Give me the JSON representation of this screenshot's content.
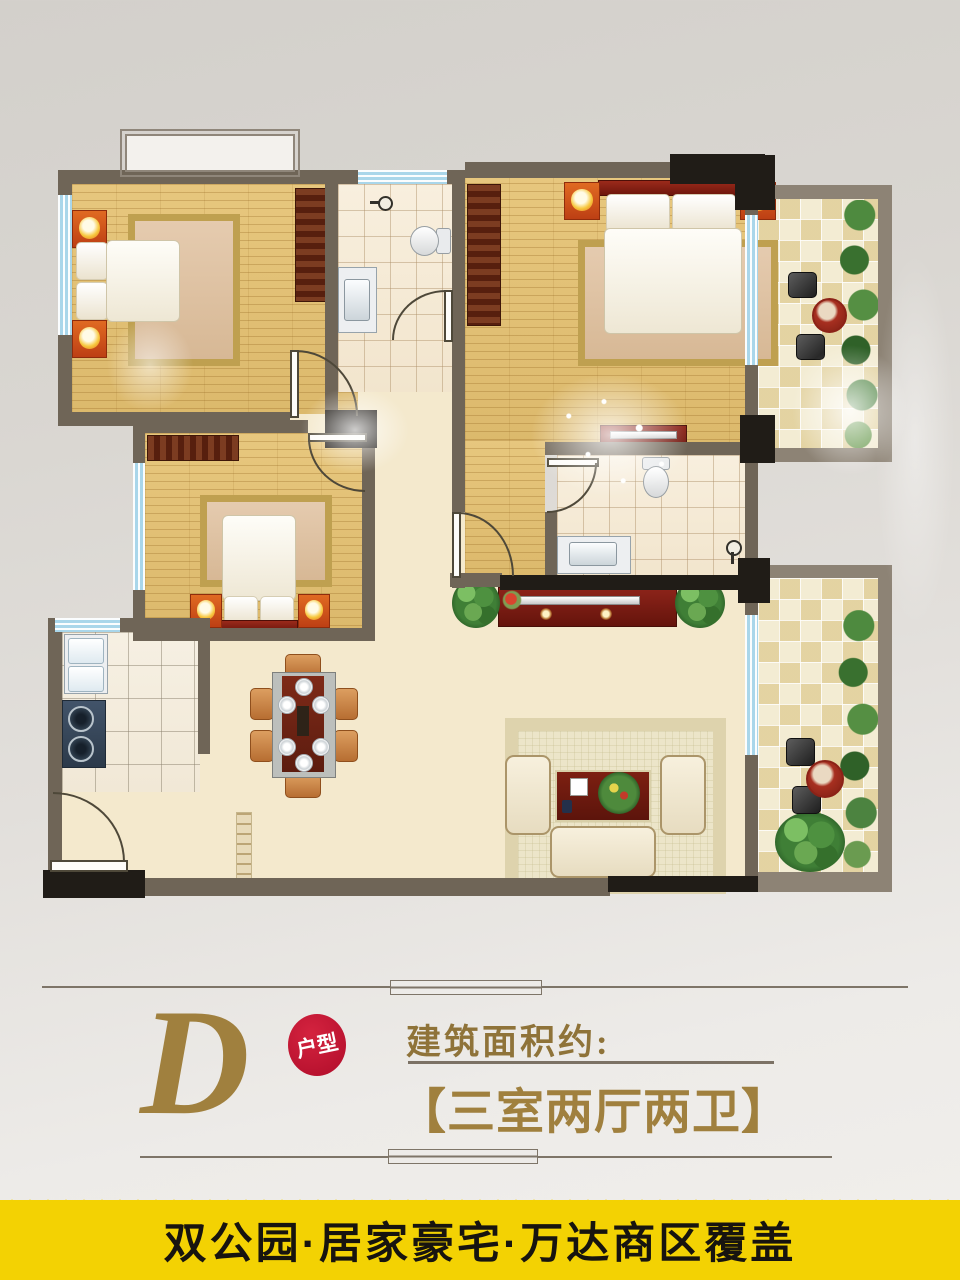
{
  "photo": {
    "background": "#dcd9d5"
  },
  "floor_plan": {
    "wall_color": "#6f6557",
    "balcony_wall_color": "#8d8375",
    "accent_black": "#201c17",
    "window_color": "#a9d6ea",
    "wood_floor_color": "#e2c176",
    "tile_floor_color": "#f6ecd9",
    "living_floor_color": "#f4e9cd",
    "rooms": [
      "bedroom-1",
      "bathroom-1",
      "master-bedroom",
      "north-balcony",
      "bedroom-2",
      "bathroom-2",
      "kitchen",
      "dining-area",
      "living-room",
      "south-balcony",
      "entry-hall"
    ],
    "furniture": [
      "double-bed",
      "nightstand-with-lamp",
      "wardrobe",
      "area-rug",
      "toilet",
      "vanity-sink",
      "shower-head",
      "kitchen-sink",
      "gas-stove",
      "dining-table-with-six-chairs",
      "runner-rug",
      "tv-stand",
      "sofa-set",
      "coffee-table-with-wreath",
      "potted-plant",
      "balcony-table-and-chairs",
      "bay-window"
    ]
  },
  "info": {
    "unit_letter": "D",
    "unit_badge": "户型",
    "area_label": "建筑面积约:",
    "layout_text": "【三室两厅两卫】",
    "gold": "#a0803e",
    "badge_red": "#b00d2a"
  },
  "banner": {
    "text": "双公园·居家豪宅·万达商区覆盖",
    "background": "#f3d203",
    "text_color": "#17140f"
  }
}
